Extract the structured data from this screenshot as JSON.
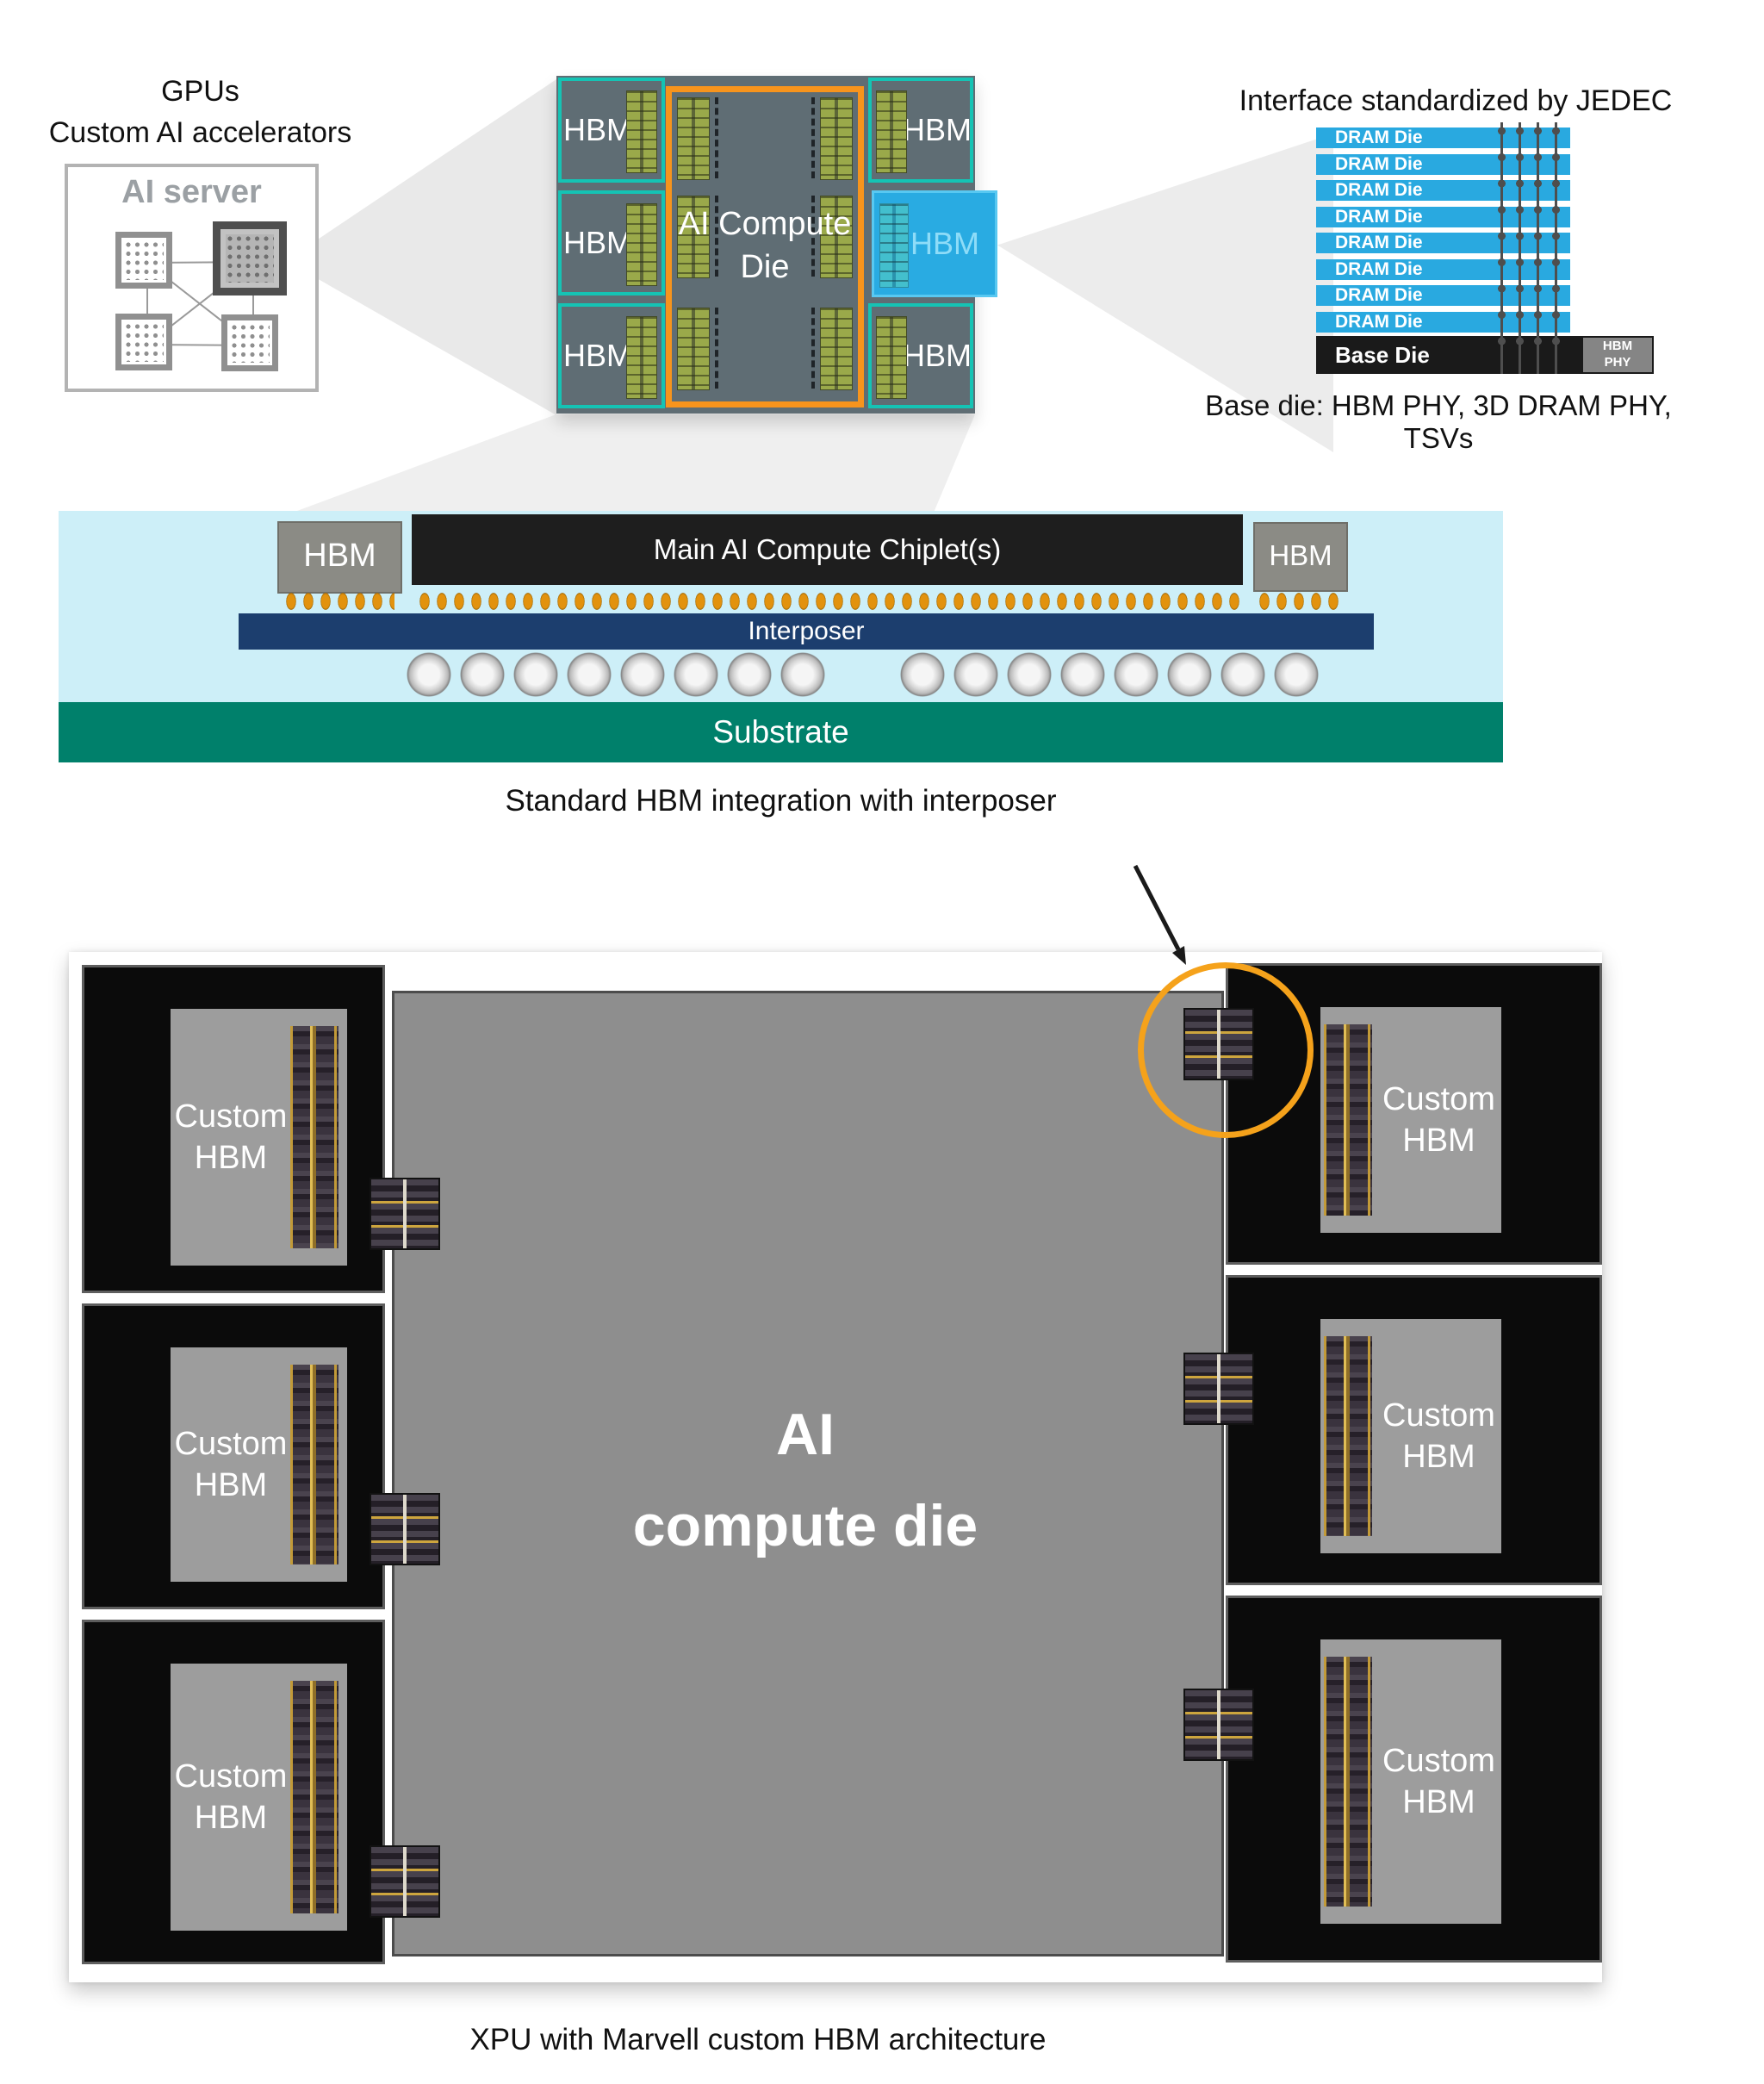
{
  "top_left": {
    "line1": "GPUs",
    "line2": "Custom AI accelerators",
    "server_title": "AI server"
  },
  "top_chip": {
    "hbm": "HBM",
    "die_line1": "AI Compute",
    "die_line2": "Die"
  },
  "jedec": {
    "title": "Interface standardized by JEDEC",
    "dram": "DRAM Die",
    "dram_die_count": 8,
    "base": "Base Die",
    "phy_line1": "HBM",
    "phy_line2": "PHY",
    "caption": "Base die: HBM PHY, 3D DRAM PHY, TSVs"
  },
  "cross_section": {
    "hbm": "HBM",
    "chiplet": "Main AI Compute Chiplet(s)",
    "interposer": "Interposer",
    "substrate": "Substrate",
    "caption": "Standard HBM integration with interposer"
  },
  "bottom": {
    "die_line1": "AI",
    "die_line2": "compute die",
    "hbm_line1": "Custom",
    "hbm_line2": "HBM",
    "custom_hbm_count": 6,
    "caption": "XPU with Marvell custom HBM architecture"
  },
  "colors": {
    "accent_orange": "#F7941D",
    "highlight_circle_orange": "#F5A21B",
    "hbm_teal_outline": "#15C3B4",
    "highlight_blue_hbm": "#29ABE2",
    "dram_blue": "#29A9E0",
    "substrate_green": "#00806B",
    "interposer_navy": "#1C3E6E",
    "chip_slate": "#5F6D74",
    "panel_light_blue": "#CDEFF8",
    "bump_orange": "#E2920E"
  }
}
